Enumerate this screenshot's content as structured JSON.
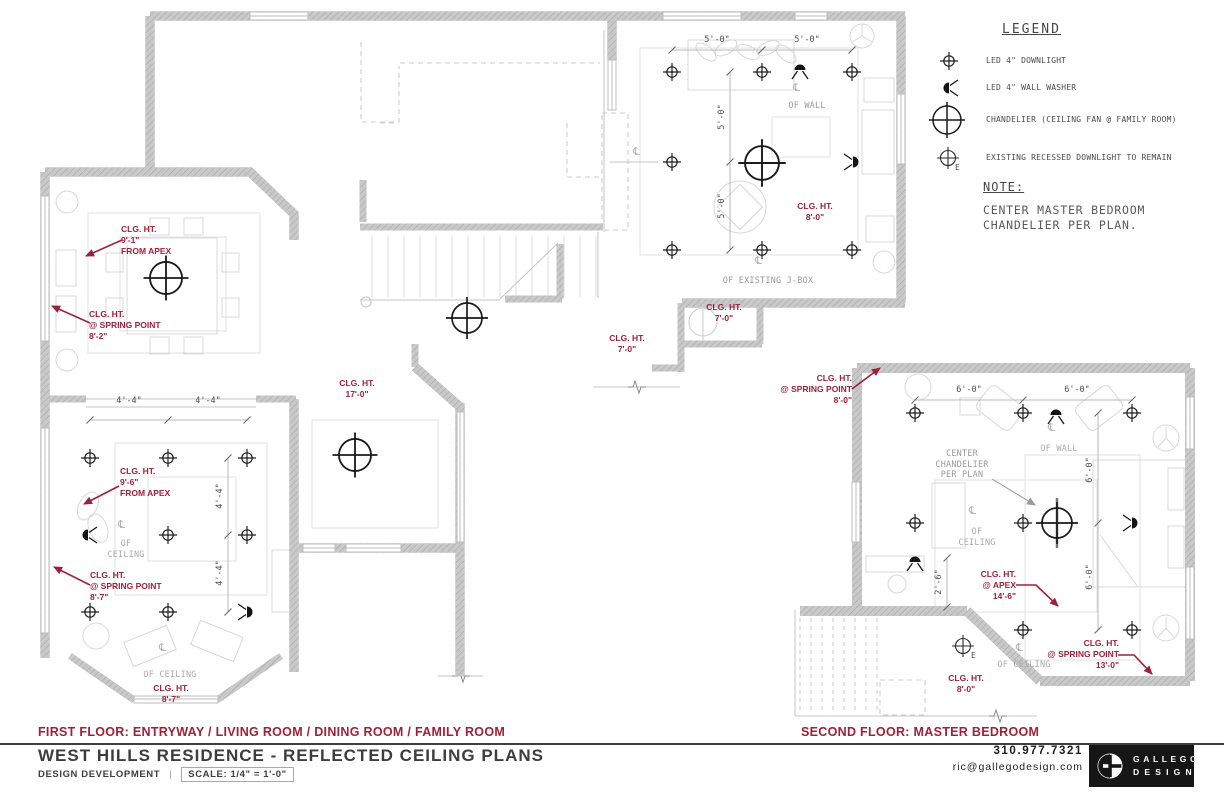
{
  "colors": {
    "annotation_red": "#9e2139",
    "wall_gray": "#c9c9c9",
    "label_gray": "#ababab",
    "ink": "#3d3d3d"
  },
  "symbols": {
    "centerline": "℄",
    "existing": "E"
  },
  "legend": {
    "title": "LEGEND",
    "items": [
      {
        "icon": "led-downlight-icon",
        "label": "LED 4\" DOWNLIGHT"
      },
      {
        "icon": "led-wall-washer-icon",
        "label": "LED 4\" WALL WASHER"
      },
      {
        "icon": "chandelier-icon",
        "label": "CHANDELIER (CEILING FAN @ FAMILY ROOM)"
      },
      {
        "icon": "existing-downlight-icon",
        "label": "EXISTING RECESSED DOWNLIGHT TO REMAIN"
      }
    ]
  },
  "note": {
    "title": "NOTE:",
    "lines": [
      "CENTER MASTER BEDROOM",
      "CHANDELIER PER PLAN."
    ]
  },
  "first_floor": {
    "caption": "FIRST FLOOR: ENTRYWAY / LIVING ROOM / DINING ROOM / FAMILY ROOM",
    "annotations": {
      "dining_apex": [
        "CLG. HT.",
        "9'-1\"",
        "FROM APEX"
      ],
      "dining_spring": [
        "CLG. HT.",
        "@ SPRING POINT",
        "8'-2\""
      ],
      "living_apex": [
        "CLG. HT.",
        "9'-6\"",
        "FROM APEX"
      ],
      "living_spring": [
        "CLG. HT.",
        "@ SPRING POINT",
        "8'-7\""
      ],
      "bay": [
        "CLG. HT.",
        "8'-7\""
      ],
      "entry": [
        "CLG. HT.",
        "17'-0\""
      ],
      "hall": [
        "CLG. HT.",
        "7'-0\""
      ],
      "alcove": [
        "CLG. HT.",
        "7'-0\""
      ],
      "family": [
        "CLG. HT.",
        "8'-0\""
      ]
    },
    "labels": {
      "living_ceiling": [
        "OF",
        "CEILING"
      ],
      "bay_ceiling": [
        "OF CEILING"
      ],
      "family_wall": [
        "OF WALL"
      ],
      "family_jbox": [
        "OF EXISTING J-BOX"
      ]
    },
    "dims": {
      "living_a": "4'-4\"",
      "living_b": "4'-4\"",
      "living_c": "4'-4\"",
      "living_d": "4'-4\"",
      "family_a": "5'-0\"",
      "family_b": "5'-0\"",
      "family_c": "5'-0\"",
      "family_d": "5'-0\""
    }
  },
  "second_floor": {
    "caption": "SECOND FLOOR: MASTER BEDROOM",
    "annotations": {
      "spring_upper": [
        "CLG. HT.",
        "@ SPRING POINT",
        "8'-0\""
      ],
      "apex": [
        "CLG. HT.",
        "@ APEX",
        "14'-6\""
      ],
      "spring_lower": [
        "CLG. HT.",
        "@ SPRING POINT",
        "13'-0\""
      ],
      "flat": [
        "CLG. HT.",
        "8'-0\""
      ]
    },
    "labels": {
      "center_chandelier": [
        "CENTER",
        "CHANDELIER",
        "PER PLAN"
      ],
      "wall": [
        "OF WALL"
      ],
      "ceiling": [
        "OF",
        "CEILING"
      ],
      "ceiling_lower": [
        "OF CEILING"
      ]
    },
    "dims": {
      "top_a": "6'-0\"",
      "top_b": "6'-0\"",
      "right_a": "6'-0\"",
      "right_b": "6'-0\"",
      "desk": "2'-6\""
    }
  },
  "title_block": {
    "project": "WEST HILLS RESIDENCE - REFLECTED CEILING PLANS",
    "phase": "DESIGN DEVELOPMENT",
    "divider": "|",
    "scale": "SCALE: 1/4\" = 1'-0\"",
    "phone": "310.977.7321",
    "email": "ric@gallegodesign.com",
    "logo_line1": "GALLEGO",
    "logo_line2": "DESIGN"
  }
}
